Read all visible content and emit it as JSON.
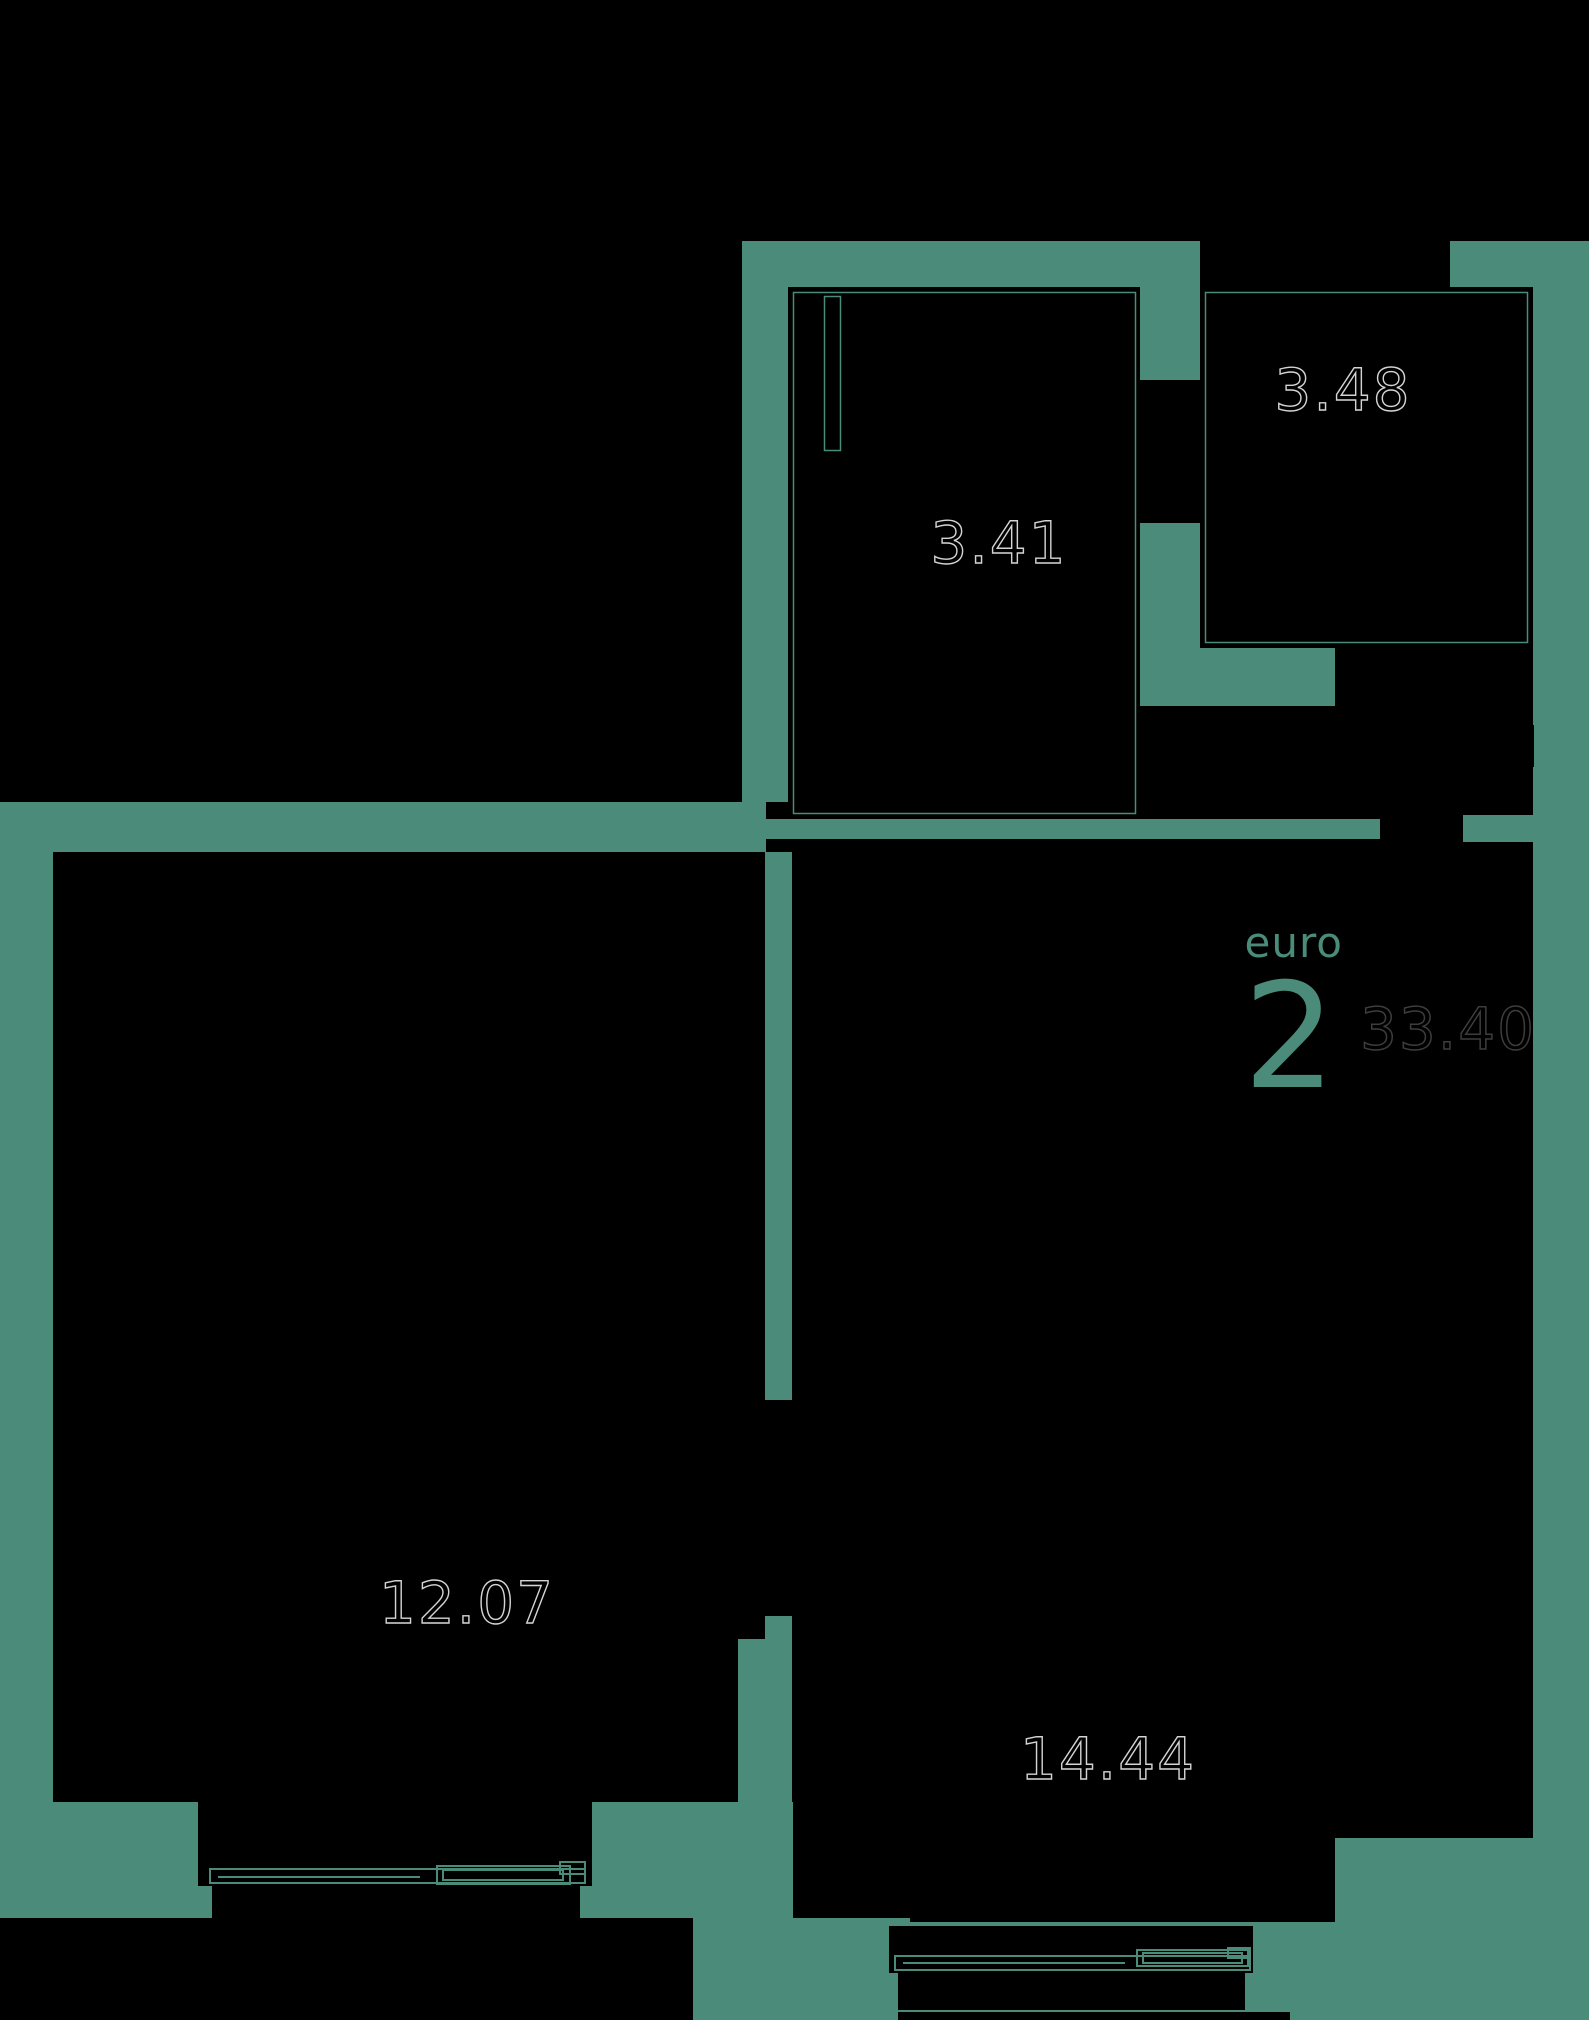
{
  "plan": {
    "badge": {
      "type_label": "euro",
      "rooms_count": "2",
      "total_area": "33.40"
    },
    "rooms": [
      {
        "id": "room-hall",
        "area": "3.48"
      },
      {
        "id": "room-bath",
        "area": "3.41"
      },
      {
        "id": "room-left",
        "area": "12.07"
      },
      {
        "id": "room-right",
        "area": "14.44"
      }
    ],
    "colors": {
      "wall": "#4a8b79",
      "background": "#000000",
      "area_label_stroke": "#d4d4d4",
      "total_area_stroke": "#3d3d3d"
    }
  }
}
